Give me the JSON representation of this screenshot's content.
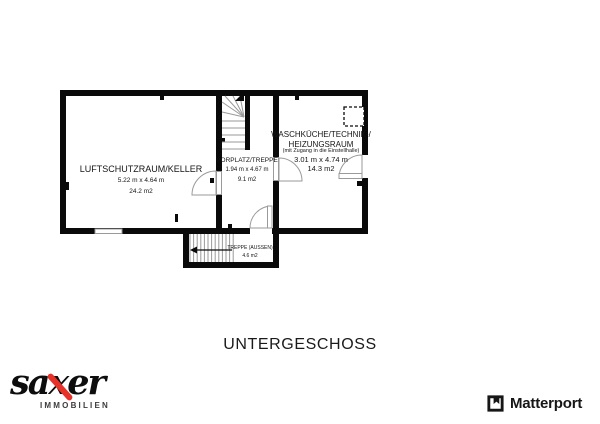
{
  "plan": {
    "floor_title": "UNTERGESCHOSS",
    "rooms": {
      "keller": {
        "name": "LUFTSCHUTZRAUM/KELLER",
        "dims": "5.22 m x 4.64 m",
        "area": "24.2 m2"
      },
      "vorplatz": {
        "name": "VORPLATZ/TREPPE",
        "dims": "1.94 m x 4.67 m",
        "area": "9.1 m2"
      },
      "waschkueche": {
        "name_line1": "WASCHKÜCHE/TECHNIK-/",
        "name_line2": "HEIZUNGSRAUM",
        "note": "(mit Zugang in die Einstellhalle)",
        "dims": "3.01 m x 4.74 m",
        "area": "14.3 m2"
      },
      "treppe_aussen": {
        "name": "TREPPE (AUSSEN)",
        "area": "4.6 m2"
      }
    }
  },
  "branding": {
    "saxer": {
      "wordmark": "saxer",
      "tagline": "IMMOBILIEN",
      "accent_color": "#e63229"
    },
    "matterport": {
      "label": "Matterport"
    }
  }
}
